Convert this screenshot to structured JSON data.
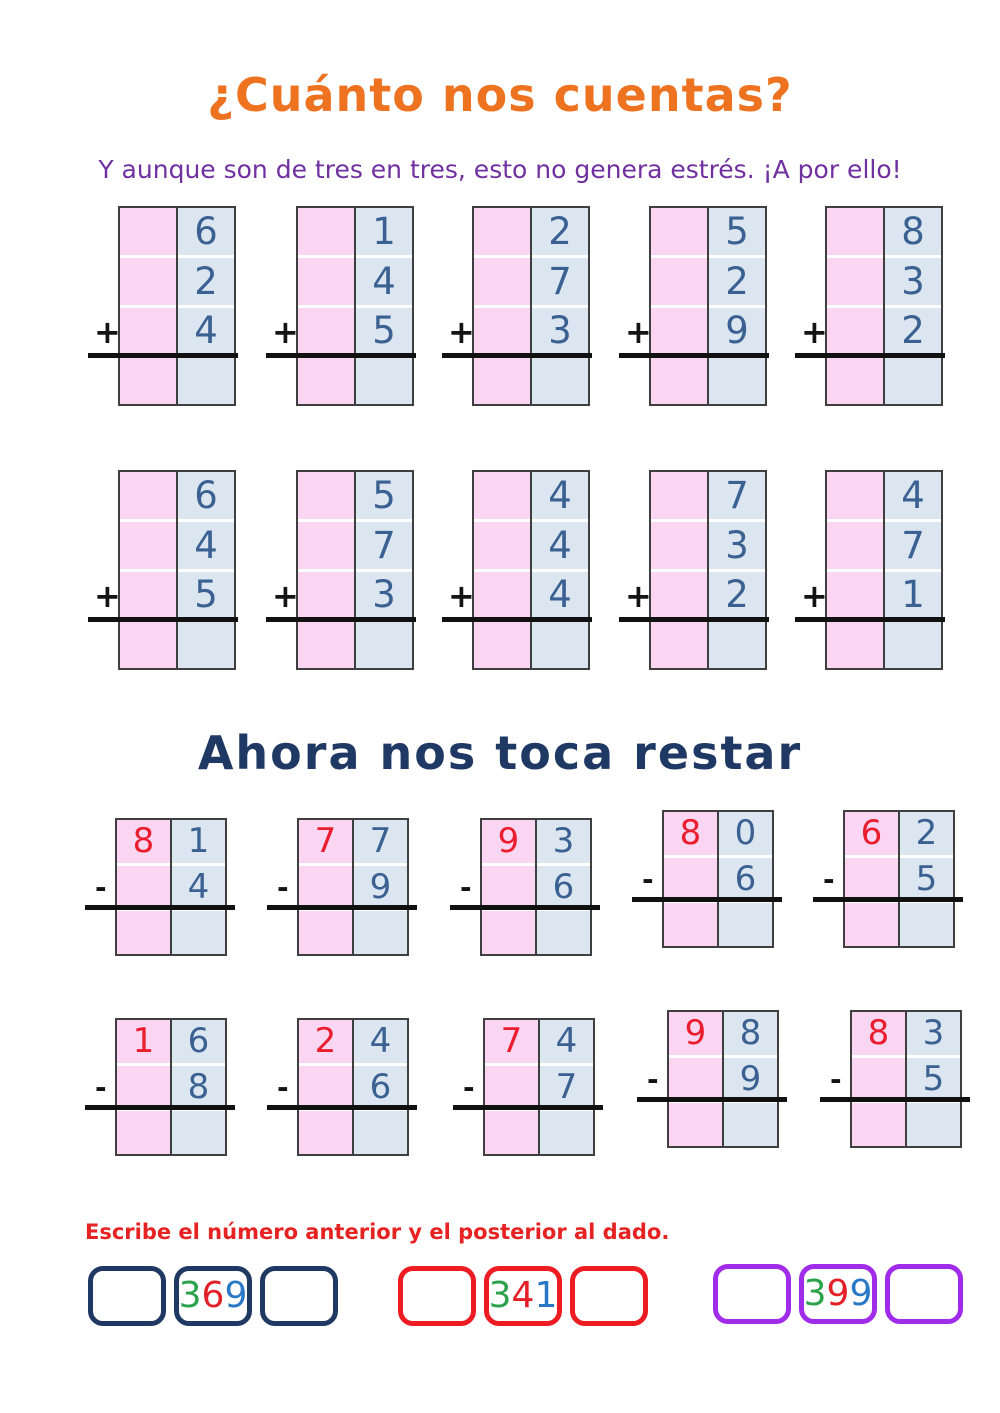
{
  "page": {
    "title": "¿Cuánto nos cuentas?",
    "subtitle": "Y aunque son de tres en tres, esto no genera estrés. ¡A por ello!",
    "subtraction_heading": "Ahora nos toca restar",
    "instruction": "Escribe el número anterior y el posterior al dado."
  },
  "addition": {
    "operator": "+",
    "row1": [
      [
        "6",
        "2",
        "4"
      ],
      [
        "1",
        "4",
        "5"
      ],
      [
        "2",
        "7",
        "3"
      ],
      [
        "5",
        "2",
        "9"
      ],
      [
        "8",
        "3",
        "2"
      ]
    ],
    "row2": [
      [
        "6",
        "4",
        "5"
      ],
      [
        "5",
        "7",
        "3"
      ],
      [
        "4",
        "4",
        "4"
      ],
      [
        "7",
        "3",
        "2"
      ],
      [
        "4",
        "7",
        "1"
      ]
    ]
  },
  "subtraction": {
    "operator": "-",
    "row1": [
      [
        "8",
        "1",
        "4"
      ],
      [
        "7",
        "7",
        "9"
      ],
      [
        "9",
        "3",
        "6"
      ],
      [
        "8",
        "0",
        "6"
      ],
      [
        "6",
        "2",
        "5"
      ]
    ],
    "row2": [
      [
        "1",
        "6",
        "8"
      ],
      [
        "2",
        "4",
        "6"
      ],
      [
        "7",
        "4",
        "7"
      ],
      [
        "9",
        "8",
        "9"
      ],
      [
        "8",
        "3",
        "5"
      ]
    ]
  },
  "number_boxes": [
    {
      "value": "369",
      "digits": [
        "3",
        "6",
        "9"
      ]
    },
    {
      "value": "341",
      "digits": [
        "3",
        "4",
        "1"
      ]
    },
    {
      "value": "399",
      "digits": [
        "3",
        "9",
        "9"
      ]
    }
  ],
  "colors": {
    "title_orange": "#EE7320",
    "subtitle_purple": "#7030A0",
    "heading_navy": "#1F3864",
    "instruction_red": "#E62222",
    "digit_blue": "#3A6191",
    "digit_red": "#EB1C2E",
    "cell_pink": "#FAD6F2",
    "cell_blue": "#DCE6F1",
    "group1_border": "#1F3864",
    "group2_border": "#ED1B22",
    "group3_border": "#A02BE8",
    "number_digit_green": "#2DA24C",
    "number_digit_red": "#E32028",
    "number_digit_blue": "#2B79C6"
  }
}
